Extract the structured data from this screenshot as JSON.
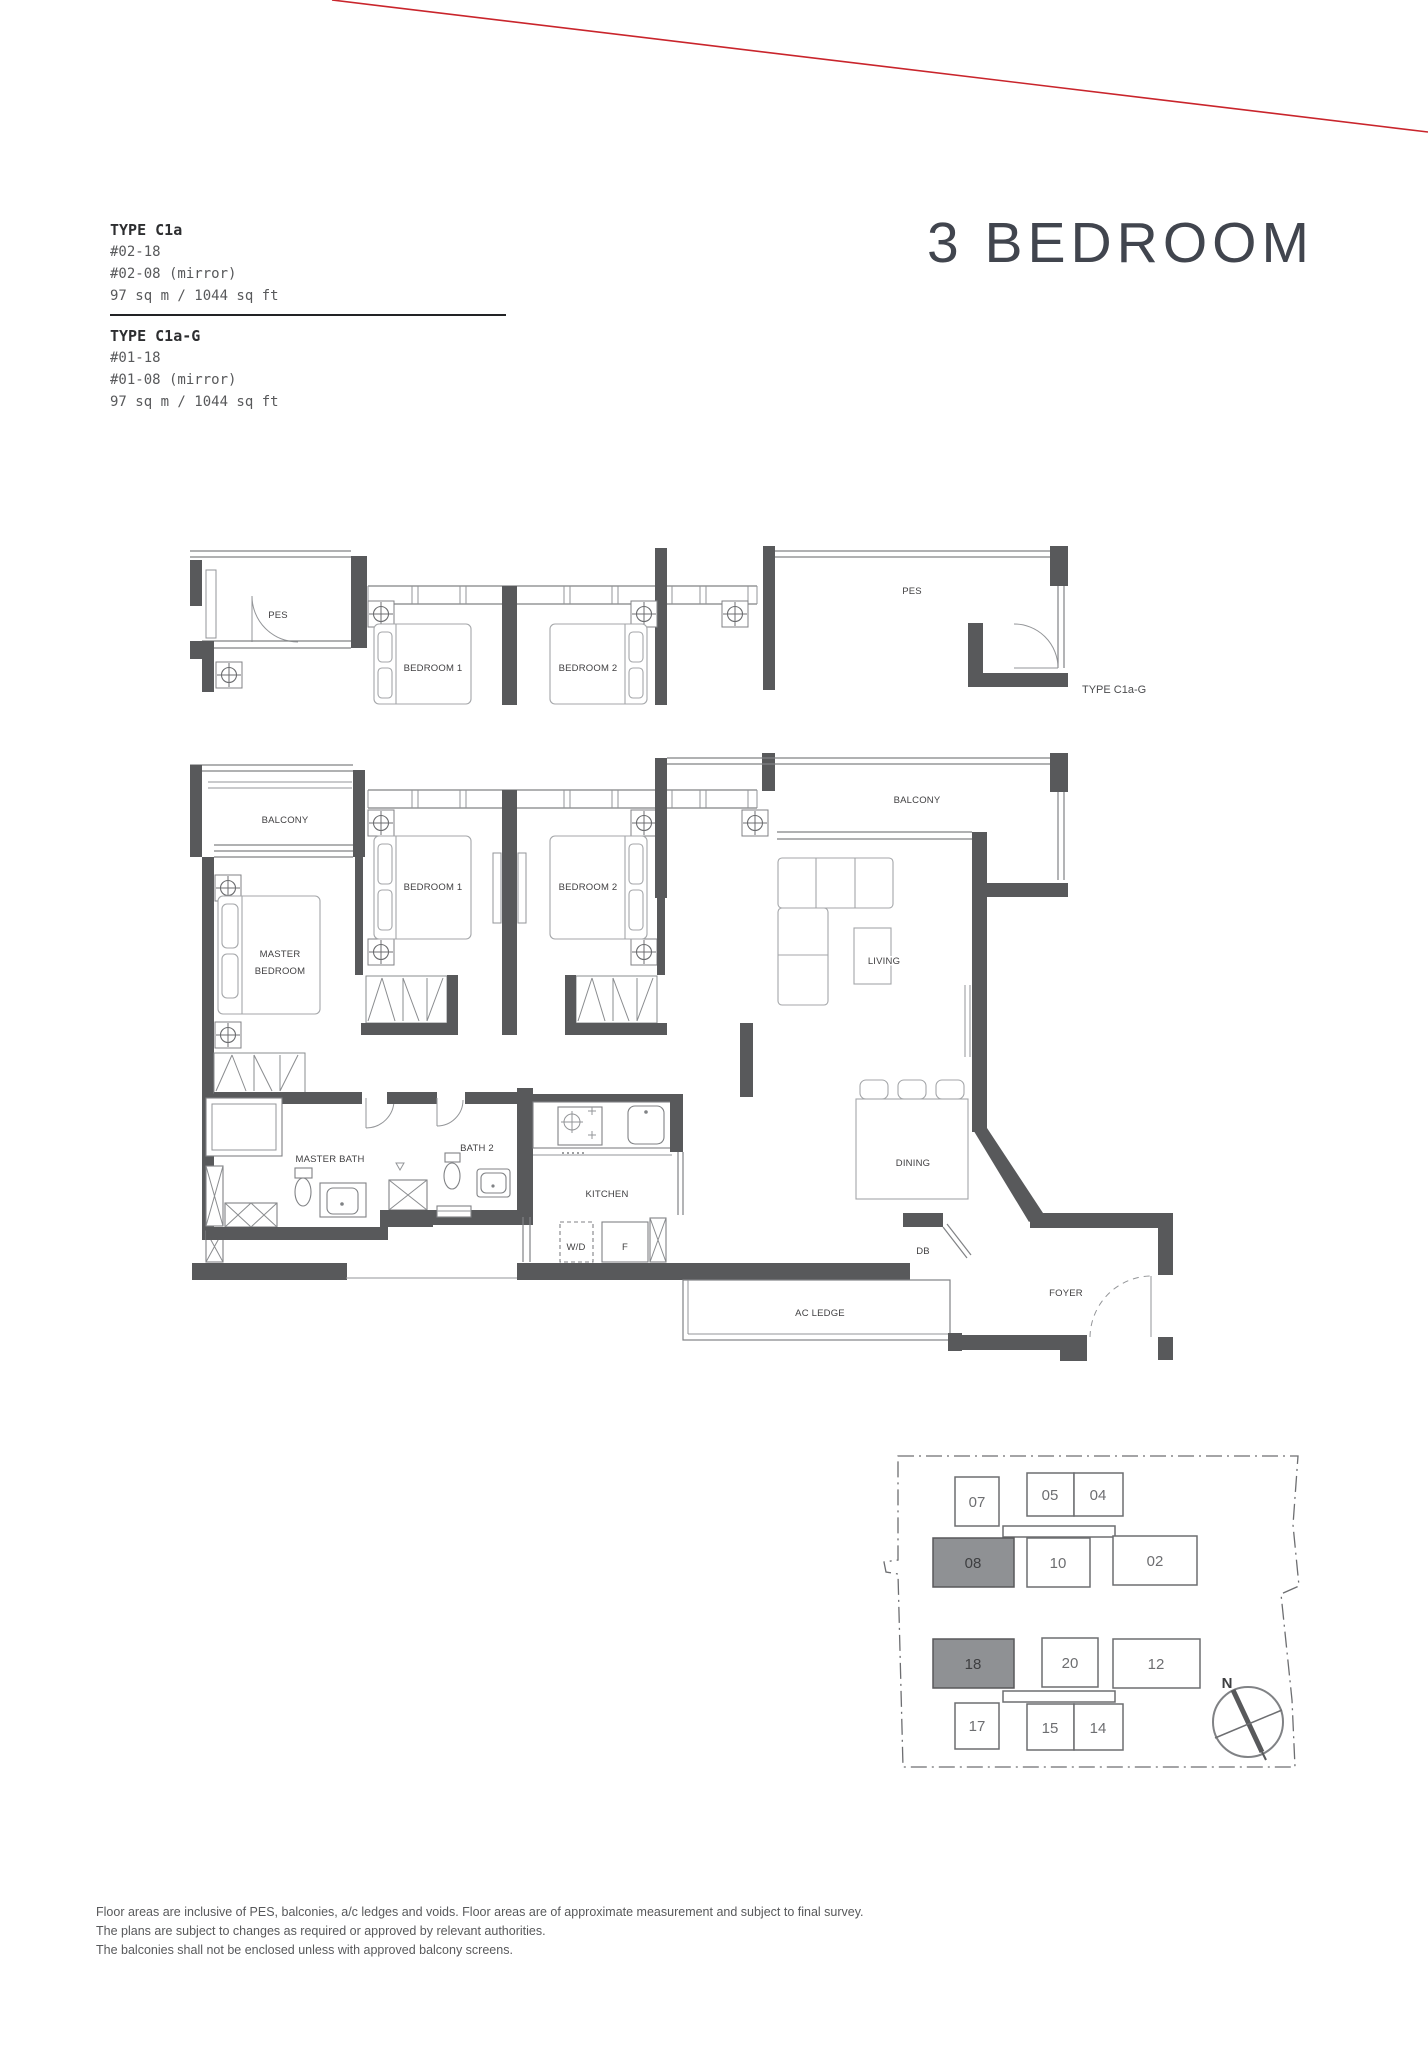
{
  "page": {
    "heading": "3 BEDROOM",
    "type_blocks": [
      {
        "title": "TYPE C1a",
        "unit1": "#02-18",
        "unit2": "#02-08 (mirror)",
        "area": "97 sq m / 1044 sq ft"
      },
      {
        "title": "TYPE C1a-G",
        "unit1": "#01-18",
        "unit2": "#01-08 (mirror)",
        "area": "97 sq m / 1044 sq ft"
      }
    ],
    "disclaimer": [
      "Floor areas are inclusive of PES, balconies, a/c ledges and voids. Floor areas are of approximate measurement and subject to final survey.",
      "The plans are subject to changes as required or approved by relevant authorities.",
      "The balconies shall not be enclosed unless with approved balcony screens."
    ]
  },
  "floorplan": {
    "labels": {
      "pes": "PES",
      "balcony": "BALCONY",
      "bedroom1": "BEDROOM 1",
      "bedroom2": "BEDROOM 2",
      "master_line1": "MASTER",
      "master_line2": "BEDROOM",
      "living": "LIVING",
      "dining": "DINING",
      "master_bath": "MASTER BATH",
      "bath2": "BATH 2",
      "kitchen": "KITCHEN",
      "wd": "W/D",
      "fridge": "F",
      "db": "DB",
      "foyer": "FOYER",
      "ac_ledge": "AC LEDGE",
      "variant_tag": "TYPE C1a-G"
    }
  },
  "keyplan": {
    "units": [
      "07",
      "05",
      "04",
      "08",
      "10",
      "02",
      "18",
      "20",
      "12",
      "17",
      "15",
      "14"
    ],
    "highlighted_units": [
      "08",
      "18"
    ],
    "compass": "N"
  },
  "colors": {
    "accent_red": "#c9252c",
    "wall": "#58595b",
    "unit_highlight": "#8f9194"
  }
}
